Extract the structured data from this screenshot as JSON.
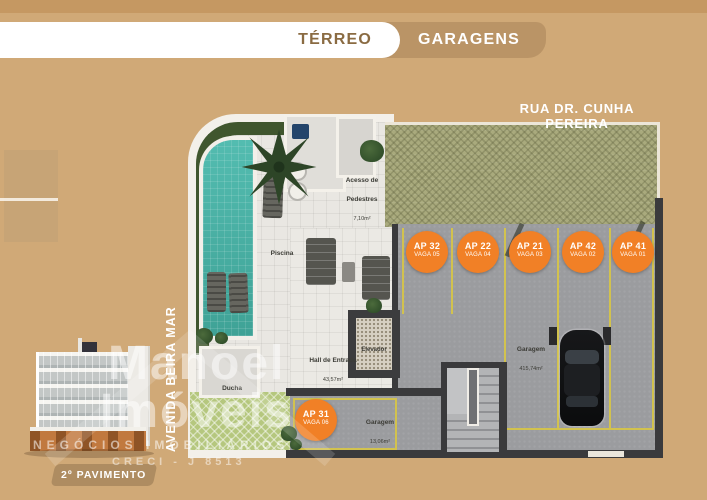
{
  "header": {
    "tabs": [
      {
        "label": "TÉRREO",
        "active": true
      },
      {
        "label": "GARAGENS",
        "active": false
      }
    ]
  },
  "streets": {
    "top": "RUA DR. CUNHA PEREIRA",
    "left": "AVENIDA BEIRA MAR"
  },
  "plan": {
    "rooms": {
      "piscina": {
        "label": "Piscina"
      },
      "ducha": {
        "label": "Ducha"
      },
      "acesso_pedestres": {
        "label": "Acesso de Pedestres",
        "area": "7,10m²"
      },
      "hall_entrada": {
        "label": "Hall de Entrada",
        "area": "43,57m²"
      },
      "elevador": {
        "label": "Elevador"
      },
      "garagem": {
        "label": "Garagem",
        "area": "415,74m²"
      },
      "garagem_vaga": {
        "label": "Garagem",
        "area": "13,06m²"
      }
    },
    "parking_spots": [
      {
        "ap": "AP 32",
        "vaga": "VAGA 05"
      },
      {
        "ap": "AP 22",
        "vaga": "VAGA 04"
      },
      {
        "ap": "AP 21",
        "vaga": "VAGA 03"
      },
      {
        "ap": "AP 42",
        "vaga": "VAGA 02"
      },
      {
        "ap": "AP 41",
        "vaga": "VAGA 01"
      },
      {
        "ap": "AP 31",
        "vaga": "VAGA 06"
      }
    ]
  },
  "footer": {
    "floor_badge": "2º PAVIMENTO"
  },
  "watermark": {
    "brand_line1": "Manoel",
    "brand_line2": "Imóveis",
    "tagline": "NEGÓCIOS IMOBILIÁRIOS",
    "creci": "CRECI - J 8513"
  },
  "colors": {
    "background": "#d0a977",
    "tab_inactive": "#ba9466",
    "accent_orange": "#f18026",
    "pool_teal": "#45aea2",
    "parking_line_yellow": "#d2c24e",
    "wall_dark": "#3a3a3c"
  }
}
